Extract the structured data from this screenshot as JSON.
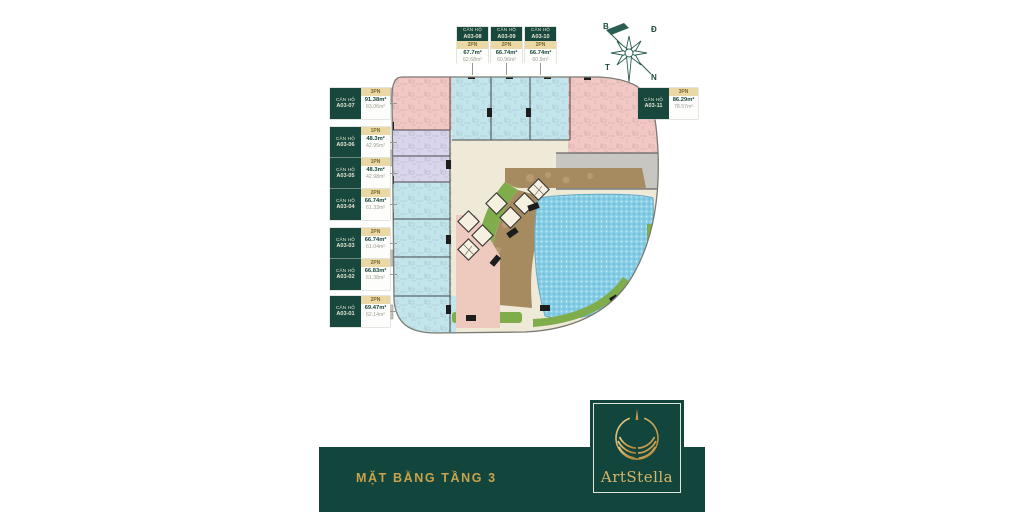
{
  "page_title": "Mặt bằng tầng 3 - ArtStella",
  "banner": {
    "title": "MẶT BẰNG TẦNG 3",
    "bg": "#12463c",
    "text_color": "#c9a24b"
  },
  "logo": {
    "brand": "ArtStella",
    "gold": "#d8b469"
  },
  "compass": {
    "north": "B",
    "east": "Đ",
    "west": "T",
    "south": "N"
  },
  "labels": {
    "prefix": "CĂN HỘ"
  },
  "units": {
    "left": [
      {
        "code": "A03-07",
        "type": "3PN",
        "gross": "91.38m²",
        "net": "83.06m²"
      },
      {
        "code": "A03-06",
        "type": "1PN",
        "gross": "48.3m²",
        "net": "42.95m²"
      },
      {
        "code": "A03-05",
        "type": "1PN",
        "gross": "48.3m²",
        "net": "42.98m²"
      },
      {
        "code": "A03-04",
        "type": "2PN",
        "gross": "66.74m²",
        "net": "61.33m²"
      },
      {
        "code": "A03-03",
        "type": "2PN",
        "gross": "66.74m²",
        "net": "61.04m²"
      },
      {
        "code": "A03-02",
        "type": "2PN",
        "gross": "66.83m²",
        "net": "61.38m²"
      },
      {
        "code": "A03-01",
        "type": "2PN",
        "gross": "69.47m²",
        "net": "62.14m²"
      }
    ],
    "top": [
      {
        "code": "A03-08",
        "type": "2PN",
        "gross": "67.7m²",
        "net": "62.68m²"
      },
      {
        "code": "A03-09",
        "type": "2PN",
        "gross": "66.74m²",
        "net": "60.96m²"
      },
      {
        "code": "A03-10",
        "type": "2PN",
        "gross": "66.74m²",
        "net": "60.9m²"
      }
    ],
    "right": [
      {
        "code": "A03-11",
        "type": "3PN",
        "gross": "86.29m²",
        "net": "78.57m²"
      }
    ]
  },
  "plan_colors": {
    "accent_green": "#12463c",
    "label_tan": "#ead9a6",
    "unit_pink": "#f3c8c4",
    "unit_blue": "#c2e5ec",
    "unit_lavender": "#d8d5ec",
    "corridor_cream": "#efe9d8",
    "pool_blue": "#85cce5",
    "deck_brown": "#a78b60",
    "landscape_green": "#80ad4b",
    "service_gray": "#c8c6c1"
  }
}
